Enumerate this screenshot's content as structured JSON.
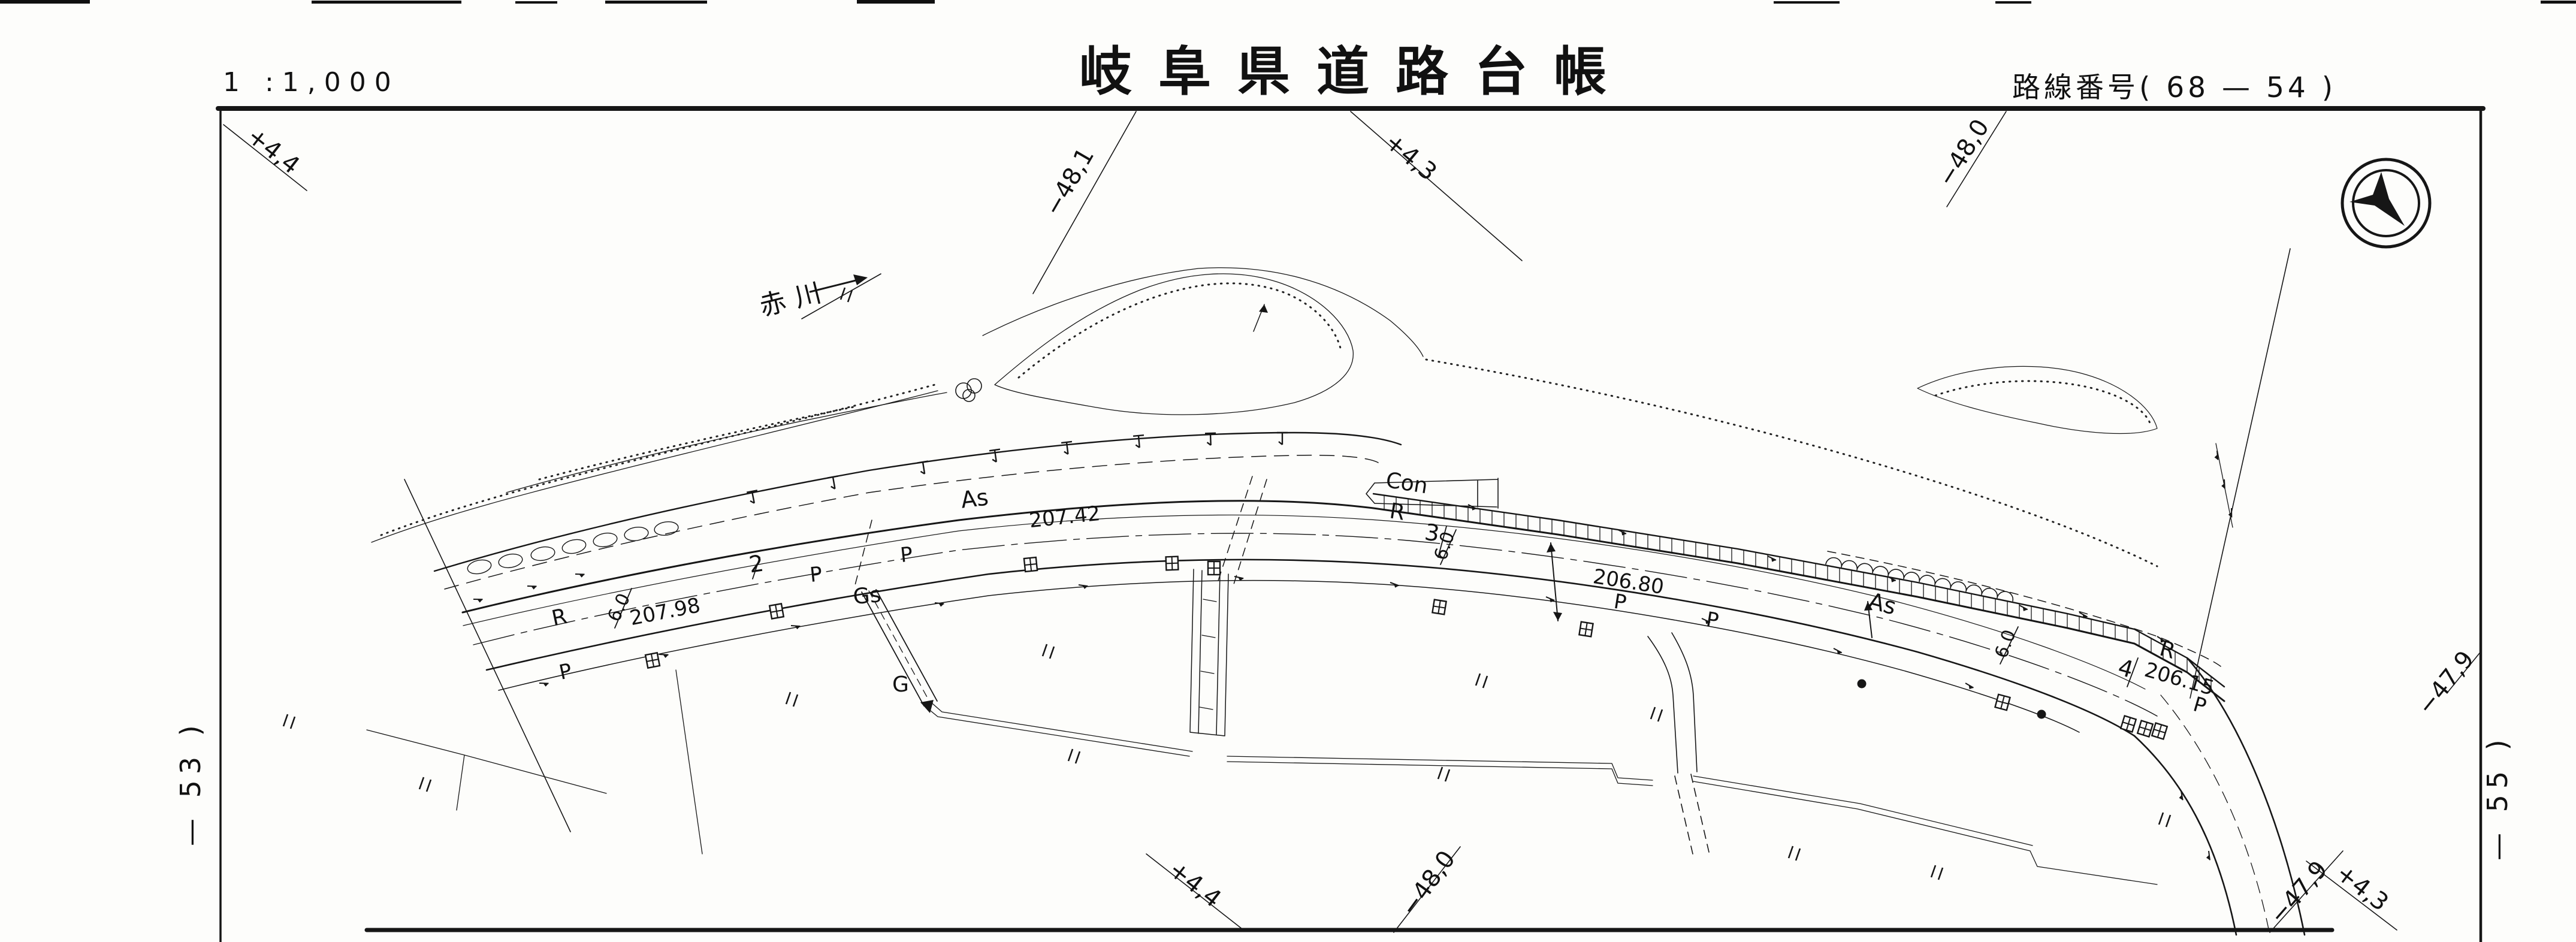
{
  "header": {
    "scale": "1 :1,000",
    "title": "岐阜県道路台帳",
    "route": "路線番号(  68  —  54  )"
  },
  "edge": {
    "left": "— 53 )",
    "right": "— 55 )"
  },
  "river": {
    "name": "赤川"
  },
  "compass": {
    "icon": "north-arrow-compass"
  },
  "grid_labels": [
    [
      "+4,4",
      448,
      262,
      38
    ],
    [
      "−48,1",
      1796,
      310,
      -60
    ],
    [
      "+4,3",
      2346,
      272,
      40
    ],
    [
      "−48,0",
      3288,
      262,
      -58
    ],
    [
      "+4,4",
      1986,
      1486,
      38
    ],
    [
      "−48,0",
      2394,
      1482,
      -54
    ],
    [
      "−47,9",
      3846,
      1498,
      -49
    ],
    [
      "+4,3",
      3934,
      1492,
      38
    ],
    [
      "−47,9",
      4092,
      1148,
      -51
    ]
  ],
  "map_labels": [
    [
      "As",
      1628,
      845,
      -7,
      38
    ],
    [
      "207.42",
      1778,
      874,
      -6,
      34
    ],
    [
      "R",
      936,
      1042,
      -12,
      36
    ],
    [
      "207.98",
      1112,
      1032,
      -11,
      34
    ],
    [
      "6.0",
      1042,
      1018,
      -65,
      30
    ],
    [
      "2",
      1264,
      954,
      -8,
      38
    ],
    [
      "P",
      1363,
      970,
      -6,
      34
    ],
    [
      "P",
      1514,
      937,
      -6,
      34
    ],
    [
      "Gs",
      1448,
      1006,
      -5,
      36
    ],
    [
      "G",
      1503,
      1154,
      0,
      36
    ],
    [
      "P",
      946,
      1132,
      -12,
      34
    ],
    [
      "Con",
      2346,
      818,
      9,
      36
    ],
    [
      "R",
      2330,
      866,
      9,
      36
    ],
    [
      "3",
      2388,
      902,
      9,
      38
    ],
    [
      "6.0",
      2420,
      914,
      -72,
      30
    ],
    [
      "206.80",
      2716,
      982,
      9,
      34
    ],
    [
      "P",
      2702,
      1016,
      9,
      34
    ],
    [
      "P",
      2856,
      1046,
      9,
      34
    ],
    [
      "As",
      3138,
      1020,
      15,
      38
    ],
    [
      "6.0",
      3356,
      1078,
      -70,
      30
    ],
    [
      "R",
      3614,
      1096,
      16,
      36
    ],
    [
      "4",
      3544,
      1128,
      16,
      38
    ],
    [
      "206.15",
      3634,
      1144,
      16,
      34
    ],
    [
      "P",
      3668,
      1188,
      16,
      34
    ]
  ],
  "symbols": {
    "ditto_mark": [
      [
        478,
        1192
      ],
      [
        705,
        1297
      ],
      [
        1317,
        1155
      ],
      [
        1408,
        480
      ],
      [
        1745,
        1075
      ],
      [
        1788,
        1250
      ],
      [
        2405,
        1280
      ],
      [
        2468,
        1124
      ],
      [
        2760,
        1180
      ],
      [
        2990,
        1412
      ],
      [
        3228,
        1444
      ],
      [
        3608,
        1356
      ]
    ],
    "catch_basin": [
      [
        1089,
        1102,
        -11
      ],
      [
        1296,
        1020,
        -10
      ],
      [
        1720,
        942,
        -6
      ],
      [
        1956,
        940,
        -2
      ],
      [
        2026,
        948,
        0
      ],
      [
        2402,
        1013,
        9
      ],
      [
        2647,
        1050,
        9
      ],
      [
        3342,
        1172,
        15
      ],
      [
        3552,
        1208,
        17
      ],
      [
        3580,
        1216,
        17
      ],
      [
        3604,
        1220,
        17
      ]
    ],
    "utility_pole": [
      [
        3107,
        1141
      ],
      [
        3407,
        1192
      ]
    ],
    "guard_post": [
      [
        1255,
        820,
        -11
      ],
      [
        1390,
        796,
        -10
      ],
      [
        1540,
        771,
        -9
      ],
      [
        1660,
        751,
        -8
      ],
      [
        1780,
        738,
        -7
      ],
      [
        1900,
        727,
        -5
      ],
      [
        2020,
        723,
        -2
      ],
      [
        2140,
        722,
        0
      ]
    ],
    "slope_tick": [
      [
        790,
        1000,
        -14
      ],
      [
        880,
        978,
        -13
      ],
      [
        960,
        958,
        -13
      ],
      [
        900,
        1140,
        -13
      ],
      [
        1100,
        1092,
        -12
      ],
      [
        1320,
        1044,
        -11
      ],
      [
        1560,
        1006,
        -9
      ],
      [
        1800,
        976,
        -7
      ],
      [
        2060,
        962,
        -3
      ],
      [
        2320,
        972,
        5
      ],
      [
        2580,
        996,
        8
      ],
      [
        2840,
        1032,
        10
      ],
      [
        3060,
        1082,
        13
      ],
      [
        3280,
        1140,
        15
      ],
      [
        2450,
        842,
        12
      ],
      [
        2700,
        884,
        11
      ],
      [
        2950,
        928,
        11
      ],
      [
        3150,
        962,
        12
      ],
      [
        3370,
        1010,
        13
      ],
      [
        3470,
        1022,
        14
      ],
      [
        3600,
        1062,
        18
      ],
      [
        3700,
        752,
        70
      ],
      [
        3712,
        800,
        72
      ],
      [
        3724,
        848,
        74
      ],
      [
        3640,
        1320,
        65
      ],
      [
        3686,
        1420,
        68
      ]
    ]
  }
}
